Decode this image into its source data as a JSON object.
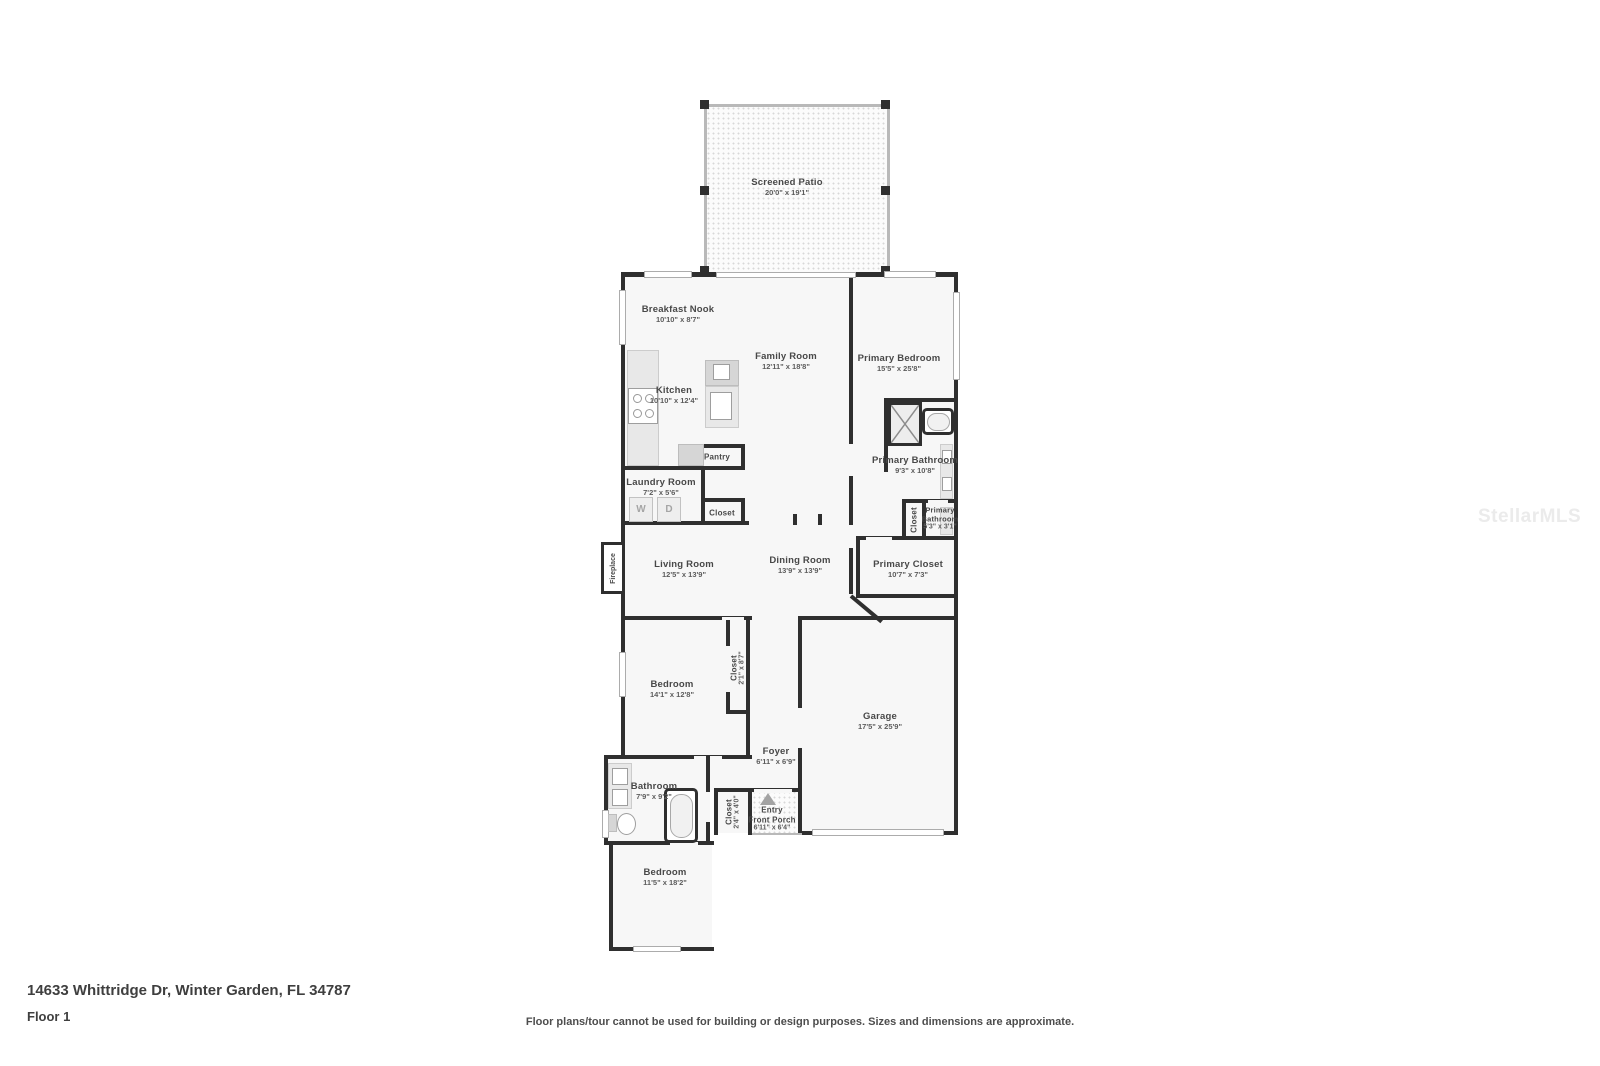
{
  "watermark": "StellarMLS",
  "footer": {
    "address": "14633 Whittridge Dr, Winter Garden, FL 34787",
    "floor": "Floor 1",
    "disclaimer": "Floor plans/tour cannot be used for building or design purposes. Sizes and dimensions are approximate."
  },
  "rooms": {
    "screened_patio": {
      "name": "Screened Patio",
      "dims": "20'0\" x 19'1\""
    },
    "breakfast_nook": {
      "name": "Breakfast Nook",
      "dims": "10'10\" x 8'7\""
    },
    "family_room": {
      "name": "Family Room",
      "dims": "12'11\" x 18'8\""
    },
    "primary_bedroom": {
      "name": "Primary Bedroom",
      "dims": "15'5\" x 25'8\""
    },
    "kitchen": {
      "name": "Kitchen",
      "dims": "10'10\" x 12'4\""
    },
    "pantry": {
      "name": "Pantry"
    },
    "primary_bathroom": {
      "name": "Primary Bathroom",
      "dims": "9'3\" x 10'8\""
    },
    "laundry_room": {
      "name": "Laundry Room",
      "dims": "7'2\" x 5'6\""
    },
    "hall_closet": {
      "name": "Closet"
    },
    "wc_closet": {
      "name": "Closet"
    },
    "primary_water_closet": {
      "name": "Primary Bathroom",
      "dims": "5'3\" x 3'1\""
    },
    "primary_closet": {
      "name": "Primary Closet",
      "dims": "10'7\" x 7'3\""
    },
    "living_room": {
      "name": "Living Room",
      "dims": "12'5\" x 13'9\""
    },
    "dining_room": {
      "name": "Dining Room",
      "dims": "13'9\" x 13'9\""
    },
    "fireplace": {
      "name": "Fireplace"
    },
    "bedroom_2": {
      "name": "Bedroom",
      "dims": "14'1\" x 12'8\""
    },
    "bedroom_2_closet": {
      "name": "Closet",
      "dims": "2'1\" x 8'7\""
    },
    "foyer": {
      "name": "Foyer",
      "dims": "6'11\" x 6'9\""
    },
    "garage": {
      "name": "Garage",
      "dims": "17'5\" x 25'9\""
    },
    "bathroom_2": {
      "name": "Bathroom",
      "dims": "7'9\" x 9'2\""
    },
    "porch_closet": {
      "name": "Closet",
      "dims": "2'4\" x 4'0\""
    },
    "entry": {
      "name": "Entry"
    },
    "front_porch": {
      "name": "Front Porch",
      "dims": "6'11\" x 6'4\""
    },
    "bedroom_3": {
      "name": "Bedroom",
      "dims": "11'5\" x 18'2\""
    }
  },
  "appliances": {
    "washer": "W",
    "dryer": "D"
  }
}
